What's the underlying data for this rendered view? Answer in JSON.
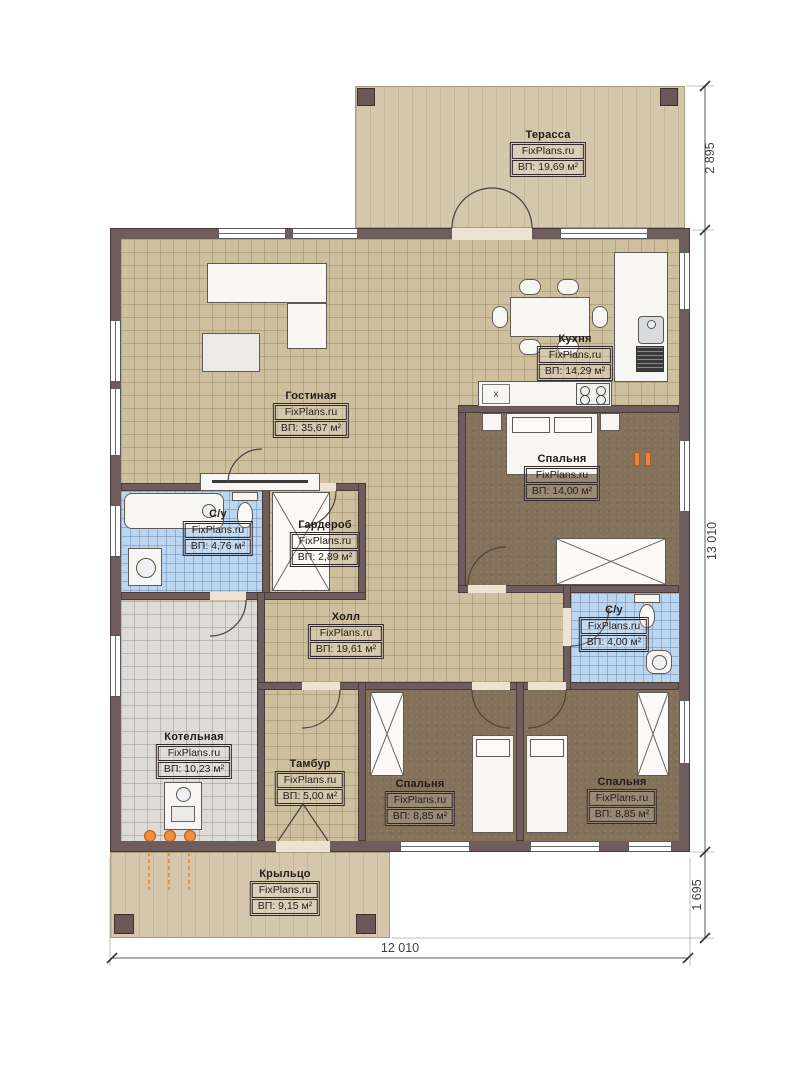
{
  "brand": "FixPlans.ru",
  "rooms": [
    {
      "name": "Терасса",
      "area": "ВП: 19,69 м²"
    },
    {
      "name": "Гостиная",
      "area": "ВП: 35,67 м²"
    },
    {
      "name": "Кухня",
      "area": "ВП: 14,29 м²"
    },
    {
      "name": "Спальня",
      "area": "ВП: 14,00 м²"
    },
    {
      "name": "С/у",
      "area": "ВП: 4,76 м²"
    },
    {
      "name": "Гардероб",
      "area": "ВП: 2,89 м²"
    },
    {
      "name": "Холл",
      "area": "ВП: 19,61 м²"
    },
    {
      "name": "С/у",
      "area": "ВП: 4,00 м²"
    },
    {
      "name": "Котельная",
      "area": "ВП: 10,23 м²"
    },
    {
      "name": "Тамбур",
      "area": "ВП: 5,00 м²"
    },
    {
      "name": "Спальня",
      "area": "ВП: 8,85 м²"
    },
    {
      "name": "Спальня",
      "area": "ВП: 8,85 м²"
    },
    {
      "name": "Крыльцо",
      "area": "ВП: 9,15 м²"
    }
  ],
  "dimensions": {
    "terrace_depth": "2 895",
    "house_side": "13 010",
    "porch_depth": "1 695",
    "house_front": "12 010"
  },
  "kitchen": {
    "cabinet_mark": "x"
  },
  "colors": {
    "wall": "#6f5c5c",
    "floor_tile": "#cec09f",
    "floor_wet": "#bcd6ef",
    "floor_bedroom": "#84715a",
    "floor_boiler": "#dcdbd7",
    "deck": "#d4c7ac",
    "gas_accent": "#e8823c"
  }
}
